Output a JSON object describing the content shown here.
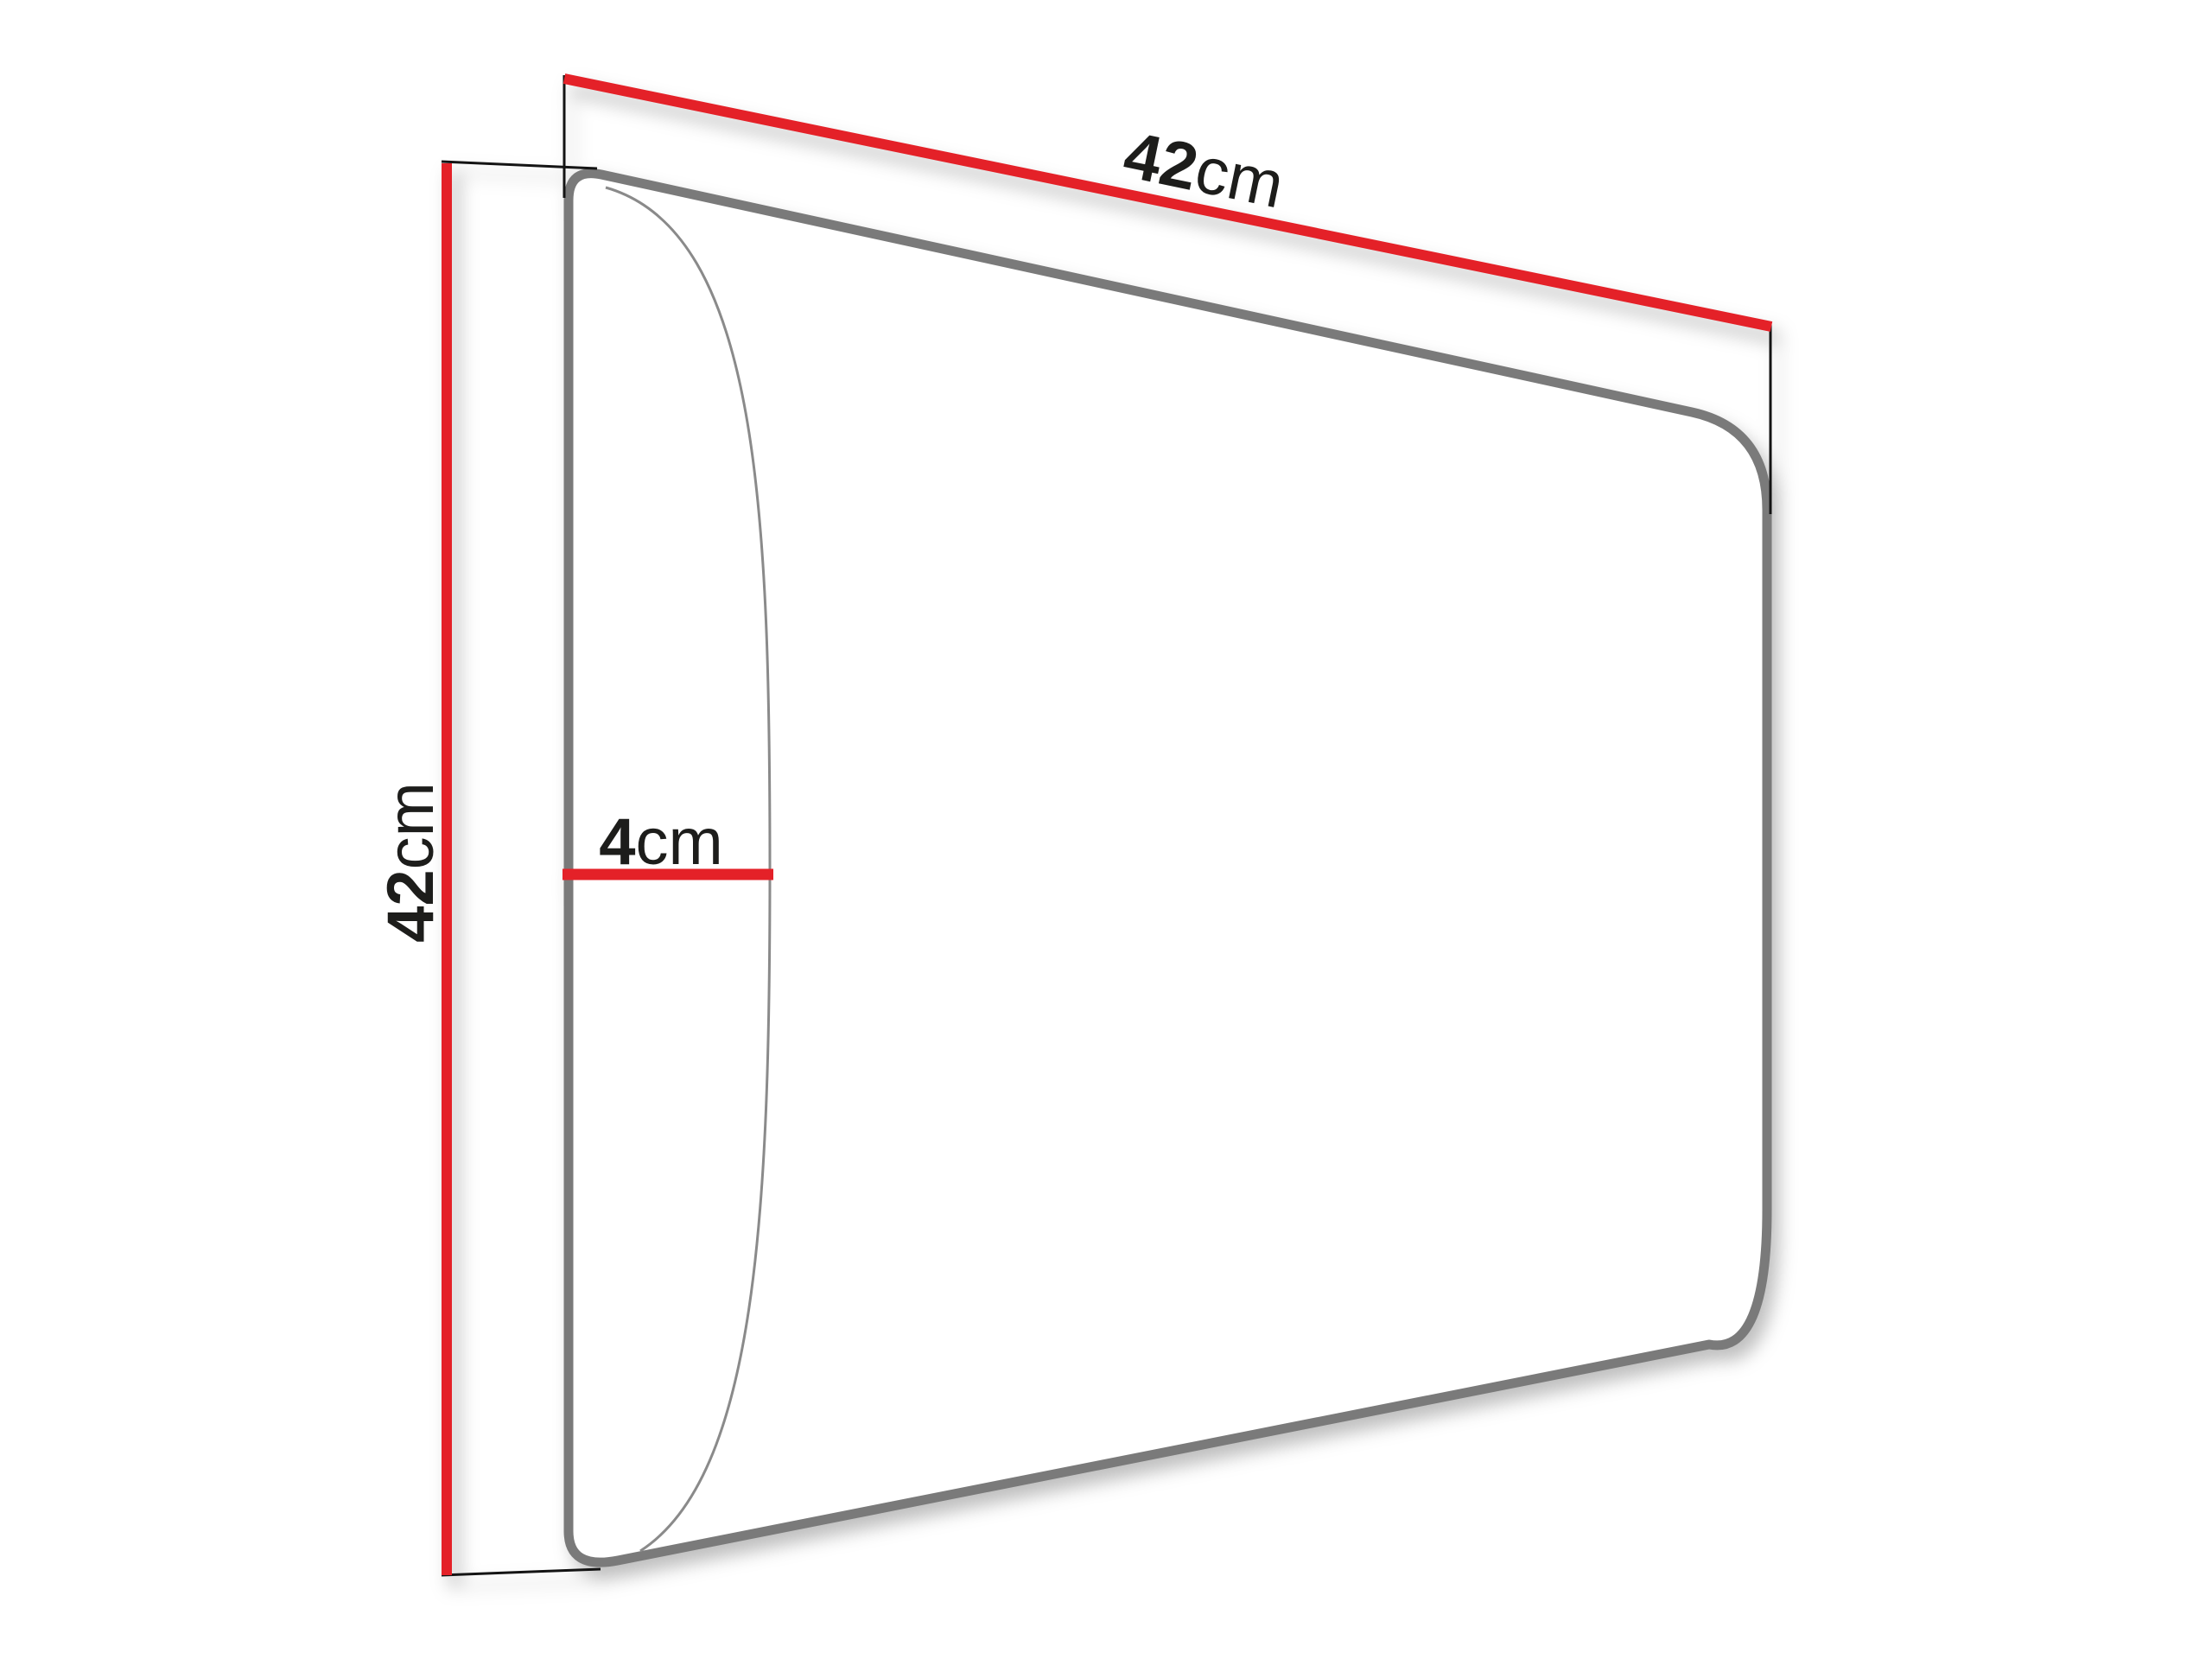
{
  "diagram": {
    "dimensions": {
      "width": {
        "value": "42",
        "unit": "cm"
      },
      "height": {
        "value": "42",
        "unit": "cm"
      },
      "depth": {
        "value": "4",
        "unit": "cm"
      }
    },
    "colors": {
      "dimension_line": "#e42128",
      "outline": "#7a7a7a",
      "front_edge": "#8a8a8a",
      "extension_line": "#141414",
      "text": "#1d1d1b",
      "background": "#ffffff"
    }
  }
}
